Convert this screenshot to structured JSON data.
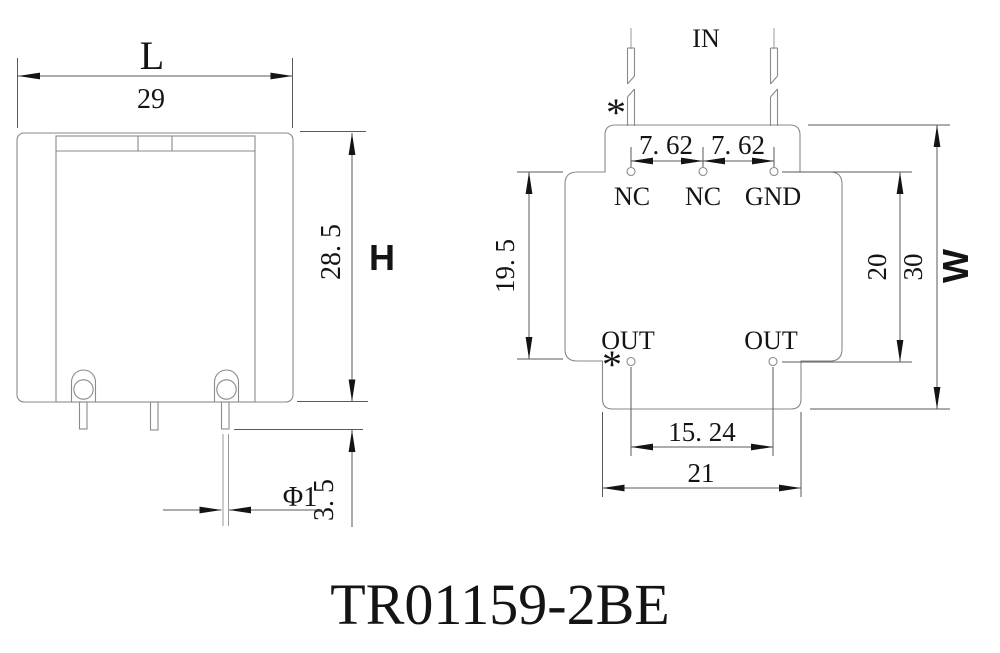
{
  "drawing": {
    "title": "TR01159-2BE",
    "colors": {
      "ink": "#141414",
      "line_gray": "#8a8a8a"
    },
    "front_view": {
      "dim_width_letter": "L",
      "dim_width_value": "29",
      "dim_height_value": "28. 5",
      "dim_height_letter": "H",
      "dim_pin_length": "3. 5",
      "dim_pin_diameter": "Φ1"
    },
    "pin_view": {
      "in_label": "IN",
      "star_top": "*",
      "star_bottom": "*",
      "pitch_left": "7. 62",
      "pitch_right": "7. 62",
      "pin_nc1": "NC",
      "pin_nc2": "NC",
      "pin_gnd": "GND",
      "pin_out1": "OUT",
      "pin_out2": "OUT",
      "dim_pin_rows": "19. 5",
      "dim_body_depth": "20",
      "dim_total_depth": "30",
      "dim_depth_letter": "W",
      "dim_out_pitch": "15. 24",
      "dim_bottom_width": "21"
    }
  }
}
